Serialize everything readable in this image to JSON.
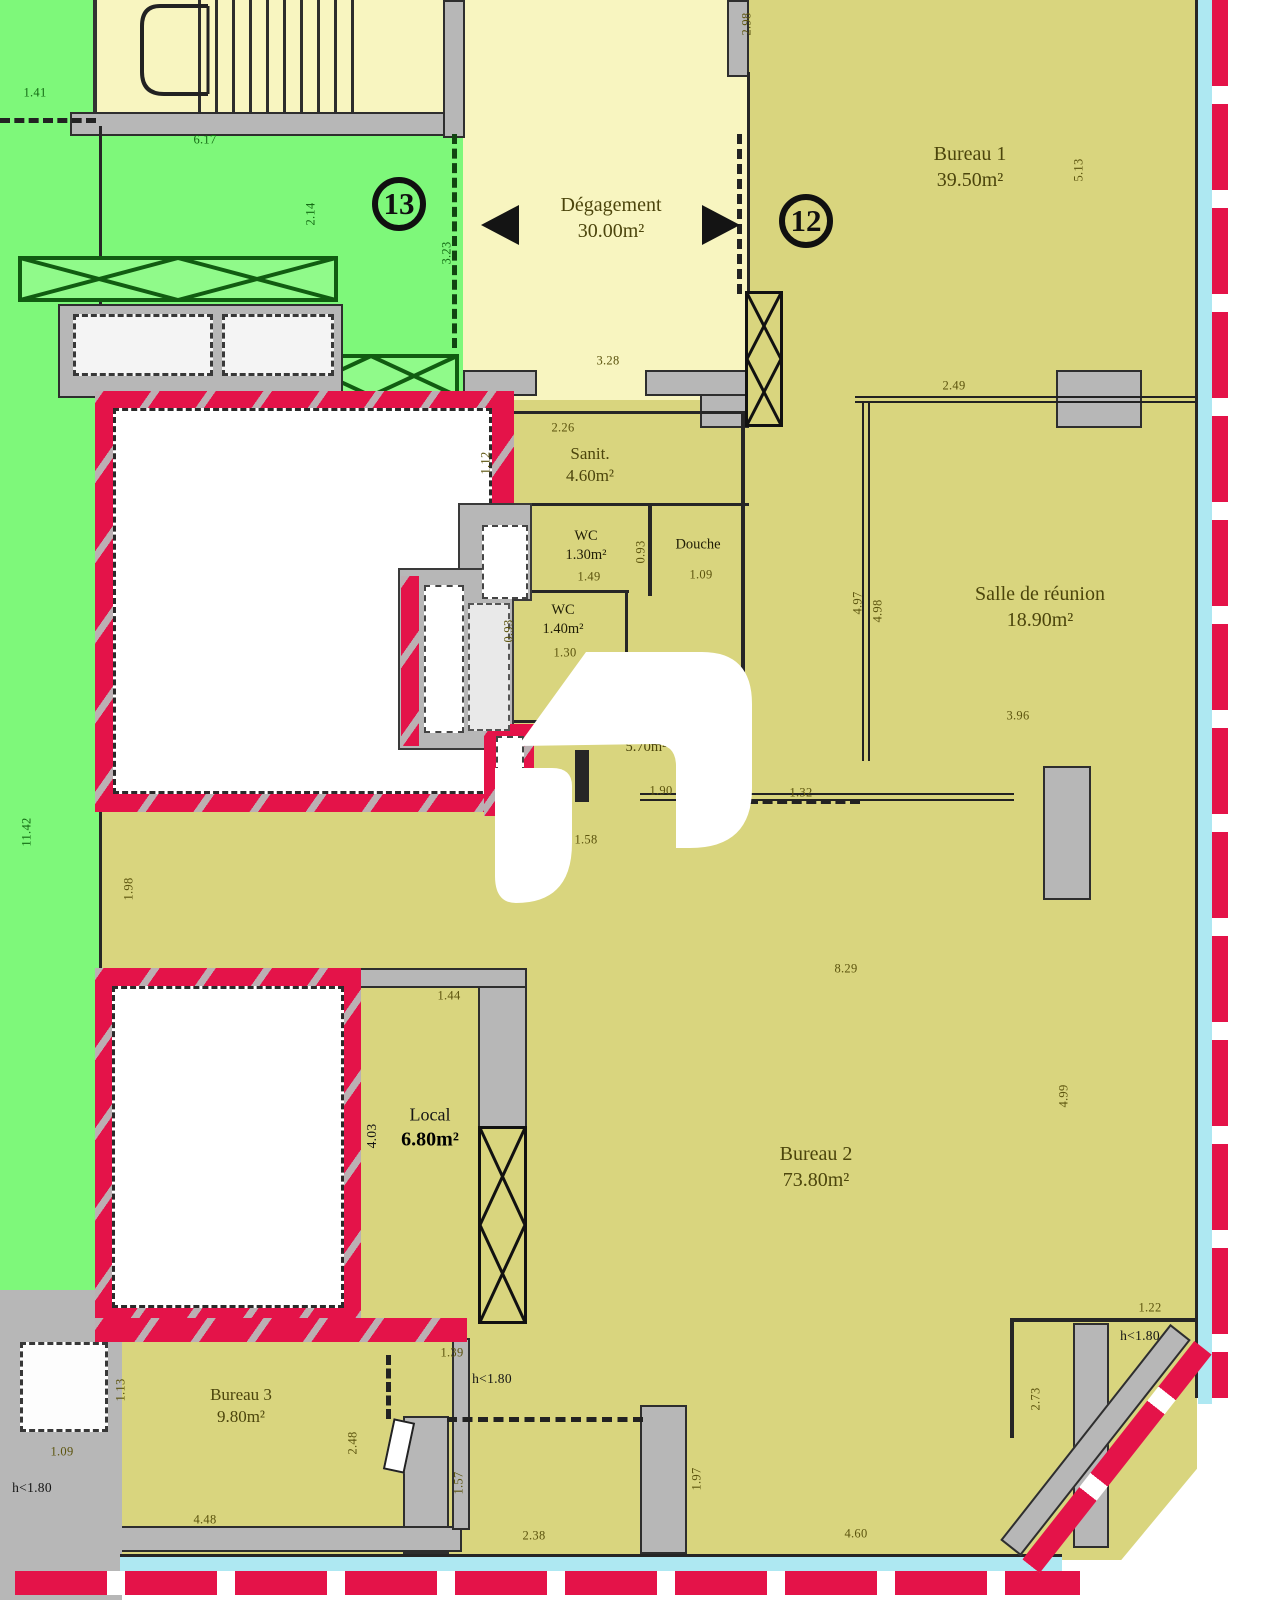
{
  "plan": {
    "rooms": [
      {
        "id": "degagement",
        "name": "Dégagement",
        "area": "30.00m²",
        "x": 611,
        "y": 218,
        "cls": "olive lg"
      },
      {
        "id": "bureau-1",
        "name": "Bureau 1",
        "area": "39.50m²",
        "x": 970,
        "y": 167,
        "cls": "olive lg"
      },
      {
        "id": "salle-de-reunion",
        "name": "Salle de réunion",
        "area": "18.90m²",
        "x": 1040,
        "y": 607,
        "cls": "olive lg"
      },
      {
        "id": "sanit",
        "name": "Sanit.",
        "area": "4.60m²",
        "x": 590,
        "y": 465,
        "cls": "olive md"
      },
      {
        "id": "wc-130",
        "name": "WC",
        "area": "1.30m²",
        "x": 586,
        "y": 546,
        "cls": "dark sm"
      },
      {
        "id": "douche",
        "name": "Douche",
        "area": "",
        "x": 698,
        "y": 545,
        "cls": "dark sm"
      },
      {
        "id": "wc-140",
        "name": "WC",
        "area": "1.40m²",
        "x": 563,
        "y": 620,
        "cls": "dark sm"
      },
      {
        "id": "salle-570",
        "name": "Salle.",
        "area": "5.70m²",
        "x": 646,
        "y": 738,
        "cls": "olive sm"
      },
      {
        "id": "bureau-2",
        "name": "Bureau 2",
        "area": "73.80m²",
        "x": 816,
        "y": 1167,
        "cls": "olive lg"
      },
      {
        "id": "local",
        "name": "Local",
        "area": "6.80m²",
        "x": 430,
        "y": 1128,
        "cls": "local"
      },
      {
        "id": "bureau-3",
        "name": "Bureau 3",
        "area": "9.80m²",
        "x": 241,
        "y": 1406,
        "cls": "olive md"
      }
    ],
    "markers": [
      {
        "label": "13",
        "x": 399,
        "y": 204
      },
      {
        "label": "12",
        "x": 806,
        "y": 221
      }
    ],
    "dims": [
      {
        "t": "1.41",
        "x": 35,
        "y": 93,
        "r": 0,
        "c": "g"
      },
      {
        "t": "6.17",
        "x": 205,
        "y": 140,
        "r": 0,
        "c": "g"
      },
      {
        "t": "2.14",
        "x": 311,
        "y": 214,
        "r": 1,
        "c": "g"
      },
      {
        "t": "3.23",
        "x": 447,
        "y": 253,
        "r": 1,
        "c": "g"
      },
      {
        "t": "11.42",
        "x": 27,
        "y": 832,
        "r": 1,
        "c": "g"
      },
      {
        "t": "2.98",
        "x": 747,
        "y": 24,
        "r": 1,
        "c": "o"
      },
      {
        "t": "5.13",
        "x": 1079,
        "y": 170,
        "r": 1,
        "c": "o"
      },
      {
        "t": "3.28",
        "x": 608,
        "y": 361,
        "r": 0,
        "c": "o"
      },
      {
        "t": "2.26",
        "x": 563,
        "y": 428,
        "r": 0,
        "c": "o"
      },
      {
        "t": "1.12",
        "x": 486,
        "y": 463,
        "r": 1,
        "c": "o"
      },
      {
        "t": "1.49",
        "x": 589,
        "y": 577,
        "r": 0,
        "c": "o"
      },
      {
        "t": "0.93",
        "x": 641,
        "y": 552,
        "r": 1,
        "c": "o"
      },
      {
        "t": "1.09",
        "x": 701,
        "y": 575,
        "r": 0,
        "c": "o"
      },
      {
        "t": "1.30",
        "x": 565,
        "y": 653,
        "r": 0,
        "c": "o"
      },
      {
        "t": "0.93",
        "x": 509,
        "y": 631,
        "r": 1,
        "c": "o"
      },
      {
        "t": "1.90",
        "x": 661,
        "y": 791,
        "r": 0,
        "c": "o"
      },
      {
        "t": "1.32",
        "x": 801,
        "y": 793,
        "r": 0,
        "c": "o"
      },
      {
        "t": "1.58",
        "x": 586,
        "y": 840,
        "r": 0,
        "c": "o"
      },
      {
        "t": "2.49",
        "x": 954,
        "y": 386,
        "r": 0,
        "c": "o"
      },
      {
        "t": "4.97",
        "x": 858,
        "y": 603,
        "r": 1,
        "c": "o"
      },
      {
        "t": "4.98",
        "x": 878,
        "y": 611,
        "r": 1,
        "c": "o"
      },
      {
        "t": "3.96",
        "x": 1018,
        "y": 716,
        "r": 0,
        "c": "o"
      },
      {
        "t": "1.98",
        "x": 129,
        "y": 889,
        "r": 1,
        "c": "o"
      },
      {
        "t": "8.29",
        "x": 846,
        "y": 969,
        "r": 0,
        "c": "o"
      },
      {
        "t": "4.99",
        "x": 1064,
        "y": 1096,
        "r": 1,
        "c": "o"
      },
      {
        "t": "1.44",
        "x": 449,
        "y": 996,
        "r": 0,
        "c": "o"
      },
      {
        "t": "4.03",
        "x": 372,
        "y": 1136,
        "r": 1,
        "c": "k"
      },
      {
        "t": "1.39",
        "x": 452,
        "y": 1353,
        "r": 0,
        "c": "o"
      },
      {
        "t": "1.22",
        "x": 1150,
        "y": 1308,
        "r": 0,
        "c": "o"
      },
      {
        "t": "h<1.80",
        "x": 1140,
        "y": 1336,
        "r": 0,
        "c": "k"
      },
      {
        "t": "2.73",
        "x": 1036,
        "y": 1399,
        "r": 1,
        "c": "o"
      },
      {
        "t": "1.13",
        "x": 121,
        "y": 1390,
        "r": 1,
        "c": "o"
      },
      {
        "t": "1.09",
        "x": 62,
        "y": 1452,
        "r": 0,
        "c": "o"
      },
      {
        "t": "h<1.80",
        "x": 32,
        "y": 1488,
        "r": 0,
        "c": "k"
      },
      {
        "t": "2.48",
        "x": 353,
        "y": 1443,
        "r": 1,
        "c": "o"
      },
      {
        "t": "4.48",
        "x": 205,
        "y": 1520,
        "r": 0,
        "c": "o"
      },
      {
        "t": "h<1.80",
        "x": 492,
        "y": 1379,
        "r": 0,
        "c": "k"
      },
      {
        "t": "1.57",
        "x": 459,
        "y": 1483,
        "r": 1,
        "c": "o"
      },
      {
        "t": "2.38",
        "x": 534,
        "y": 1536,
        "r": 0,
        "c": "o"
      },
      {
        "t": "1.97",
        "x": 697,
        "y": 1479,
        "r": 1,
        "c": "o"
      },
      {
        "t": "4.60",
        "x": 856,
        "y": 1534,
        "r": 0,
        "c": "o"
      }
    ]
  },
  "colors": {
    "zone_green": "#7ef87a",
    "room_khaki": "#d9d57e",
    "room_pale_yellow": "#f8f5c0",
    "demolition_red": "#e41349",
    "glazing_cyan": "#aee8f2",
    "wall_gray": "#b7b7b7"
  }
}
